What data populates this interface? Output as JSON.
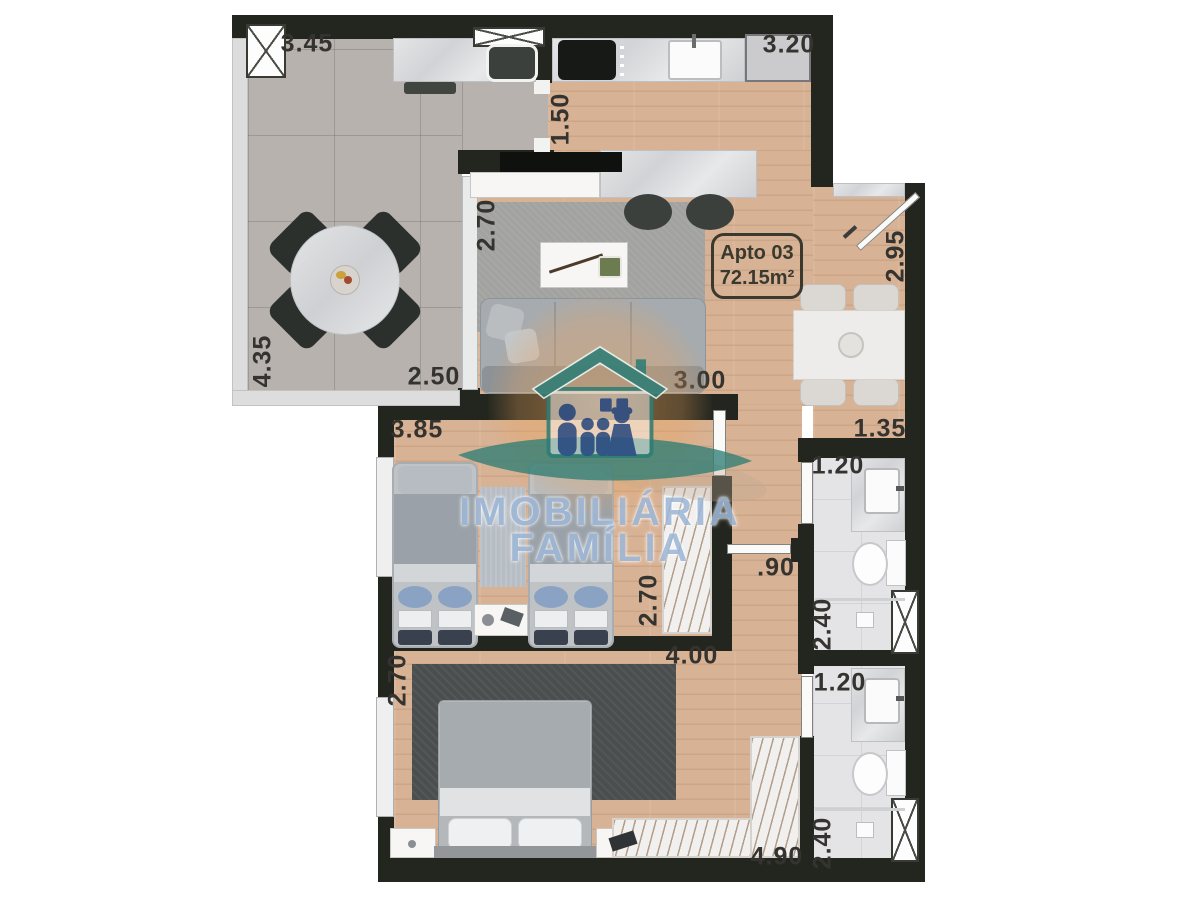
{
  "unit_box": {
    "line1": "Apto 03",
    "line2": "72.15m²"
  },
  "watermark": {
    "line1": "IMOBILIÁRIA",
    "line2": "FAMÍLIA"
  },
  "dimensions": [
    {
      "text": "3.45",
      "x": 307,
      "y": 44,
      "v": false
    },
    {
      "text": "3.20",
      "x": 789,
      "y": 45,
      "v": false
    },
    {
      "text": "1.50",
      "x": 561,
      "y": 119,
      "v": true
    },
    {
      "text": "2.70",
      "x": 487,
      "y": 225,
      "v": true
    },
    {
      "text": "2.95",
      "x": 896,
      "y": 256,
      "v": true
    },
    {
      "text": "4.35",
      "x": 263,
      "y": 361,
      "v": true
    },
    {
      "text": "2.50",
      "x": 434,
      "y": 377,
      "v": false
    },
    {
      "text": "3.00",
      "x": 700,
      "y": 381,
      "v": false
    },
    {
      "text": "1.35",
      "x": 880,
      "y": 429,
      "v": false
    },
    {
      "text": "3.85",
      "x": 417,
      "y": 430,
      "v": false
    },
    {
      "text": "1.20",
      "x": 838,
      "y": 466,
      "v": false
    },
    {
      "text": "2.70",
      "x": 649,
      "y": 600,
      "v": true
    },
    {
      "text": "4.00",
      "x": 692,
      "y": 656,
      "v": false
    },
    {
      "text": ".90",
      "x": 776,
      "y": 568,
      "v": false
    },
    {
      "text": "2.40",
      "x": 823,
      "y": 624,
      "v": true
    },
    {
      "text": "1.20",
      "x": 840,
      "y": 683,
      "v": false
    },
    {
      "text": "2.70",
      "x": 398,
      "y": 680,
      "v": true
    },
    {
      "text": "2.40",
      "x": 823,
      "y": 843,
      "v": true
    },
    {
      "text": "4.90",
      "x": 777,
      "y": 857,
      "v": false
    }
  ],
  "colors": {
    "wall": "#23261f",
    "wood": "#d8b294",
    "tile": "#b8b2ae",
    "bath": "#e4e4e7",
    "label": "#34332f",
    "wmblue": "#9fb8d8",
    "logo_blue": "#2e4f87",
    "logo_teal": "#2f7d74",
    "logo_orange": "#eaa35c"
  }
}
